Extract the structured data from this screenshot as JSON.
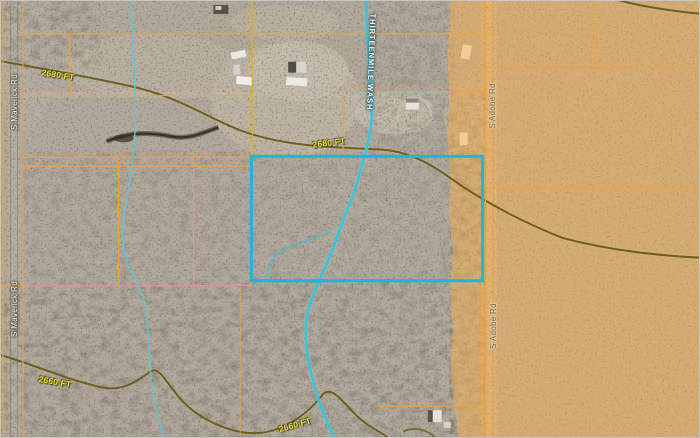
{
  "map": {
    "view": "satellite-parcel-view",
    "labels": {
      "road_maverick": "S Maverick Rd",
      "road_adobe": "S Adobe Rd",
      "wash": "THIRTEENMILE WASH",
      "contour_2680": "2680 FT",
      "contour_2660": "2660 FT"
    },
    "features": {
      "selected_parcel": "highlighted rectangular parcel",
      "wash_name": "Thirteenmile Wash",
      "elevation_contours_ft": [
        2660,
        2680
      ]
    },
    "colors": {
      "terrain_base": "#b2a99b",
      "land_tint_overlay": "#f5ae4e",
      "parcel_line": "#f0a23d",
      "selected_parcel": "#1bb6da",
      "wash": "#3fc2d8",
      "contour": "#6d5d20",
      "contour_label": "#e9e23d"
    }
  }
}
